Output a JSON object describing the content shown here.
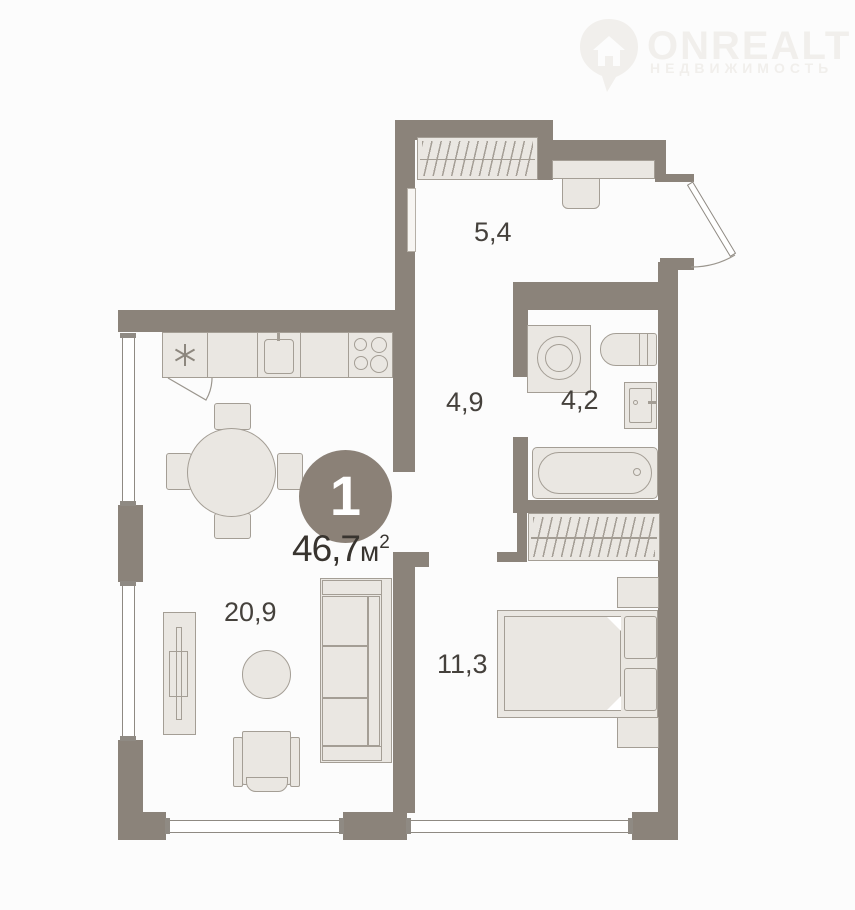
{
  "watermark": {
    "brand": "ONREALT",
    "subtitle": "НЕДВИЖИМОСТЬ",
    "icon": "house-pin-icon"
  },
  "plan": {
    "unit_badge": "1",
    "total_area": {
      "value": "46,7",
      "unit": "м",
      "exponent": "2"
    },
    "rooms": [
      {
        "name": "entry-hall",
        "area": "5,4"
      },
      {
        "name": "corridor",
        "area": "4,9"
      },
      {
        "name": "bathroom",
        "area": "4,2"
      },
      {
        "name": "living-kitchen",
        "area": "20,9"
      },
      {
        "name": "bedroom",
        "area": "11,3"
      }
    ],
    "fixtures": [
      "entry-wardrobe",
      "hall-counter",
      "hall-console",
      "electric-panel",
      "fridge",
      "kitchen-cabinet",
      "kitchen-sink",
      "stove",
      "dining-table",
      "chairs",
      "sofa",
      "coffee-table",
      "armchair",
      "tv-stand",
      "washing-machine",
      "toilet",
      "wash-basin",
      "bathtub",
      "bedroom-wardrobe",
      "double-bed",
      "pillows",
      "nightstand-top",
      "nightstand-bottom",
      "entrance-door",
      "windows"
    ],
    "icons": {
      "fridge_marker": "snowflake-asterisk"
    }
  },
  "colors": {
    "wall": "#8b837a",
    "furniture_fill": "#eae7e2",
    "furniture_stroke": "#a49e95",
    "label_text": "#45413c",
    "badge_bg": "#8b8177",
    "watermark": "#f1efec",
    "background": "#fcfcfc"
  }
}
